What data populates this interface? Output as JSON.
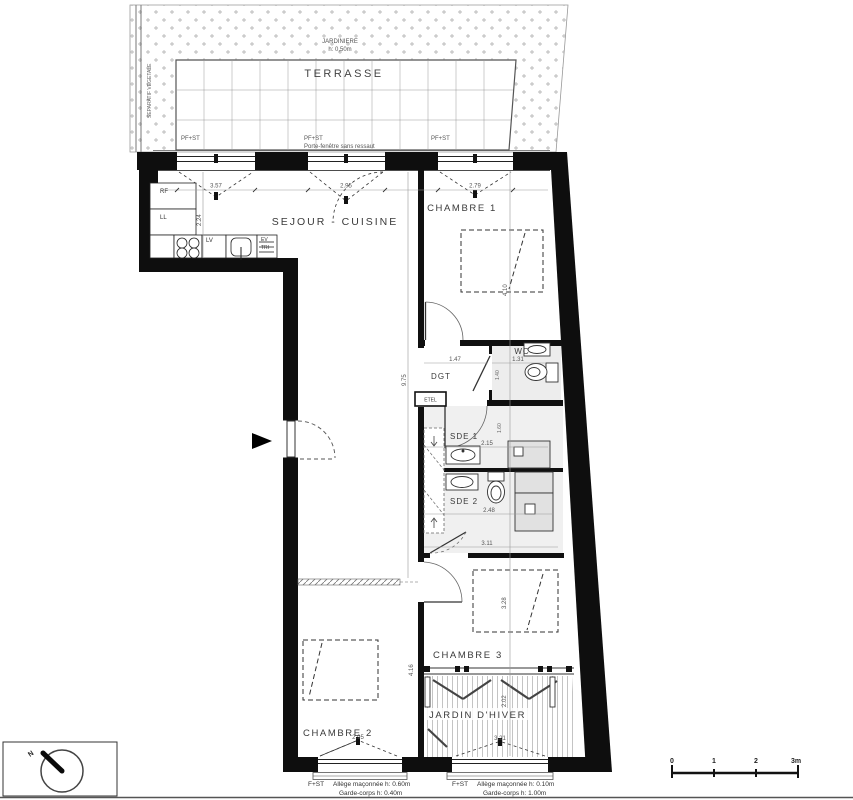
{
  "terrace": {
    "label": "TERRASSE",
    "jardiniere": "JARDINIERE",
    "jardiniere_h": "h: 0,50m",
    "separatif": "SEPARATIF VEGETALE",
    "pf1": "PF+ST",
    "pf2": "PF+ST",
    "pf3": "PF+ST",
    "pf_note": "Porte-fenêtre sans ressaut"
  },
  "rooms": {
    "sejour": "SEJOUR - CUISINE",
    "chambre1": "CHAMBRE 1",
    "chambre2": "CHAMBRE 2",
    "chambre3": "CHAMBRE 3",
    "wc": "WC",
    "dgt": "DGT",
    "sde1": "SDE 1",
    "sde2": "SDE 2",
    "jardin": "JARDIN D'HIVER"
  },
  "kitchen": {
    "rf": "RF",
    "ll": "LL",
    "lv": "LV",
    "ev": "EV",
    "tri": "TRI"
  },
  "etel": "ETEL",
  "dims": {
    "top_a": "3.57",
    "top_b": "2.95",
    "ch1_w": "2.79",
    "kitchen_v": "2.24",
    "corridor_v": "9.75",
    "ch1_v": "4.10",
    "dgt_w": "1.47",
    "wc_w": "1.31",
    "wc_v": "1.40",
    "sde1_v": "1.60",
    "sde1_w": "2.15",
    "sde2_w": "2.48",
    "sde_b": "3.11",
    "ch2_w": "2.95",
    "ch2_v": "4.16",
    "ch3_v": "3.28",
    "jardin_v": "2.02",
    "jardin_w": "3.21"
  },
  "notes": {
    "w1_tag": "F+ST",
    "w1_line1": "Allège maçonnée h: 0.60m",
    "w1_line2": "Garde-corps h: 0.40m",
    "w2_tag": "F+ST",
    "w2_line1": "Allège maçonnée h: 0.10m",
    "w2_line2": "Garde-corps h: 1.00m"
  },
  "scale": {
    "t0": "0",
    "t1": "1",
    "t2": "2",
    "t3": "3m"
  },
  "north": "N"
}
